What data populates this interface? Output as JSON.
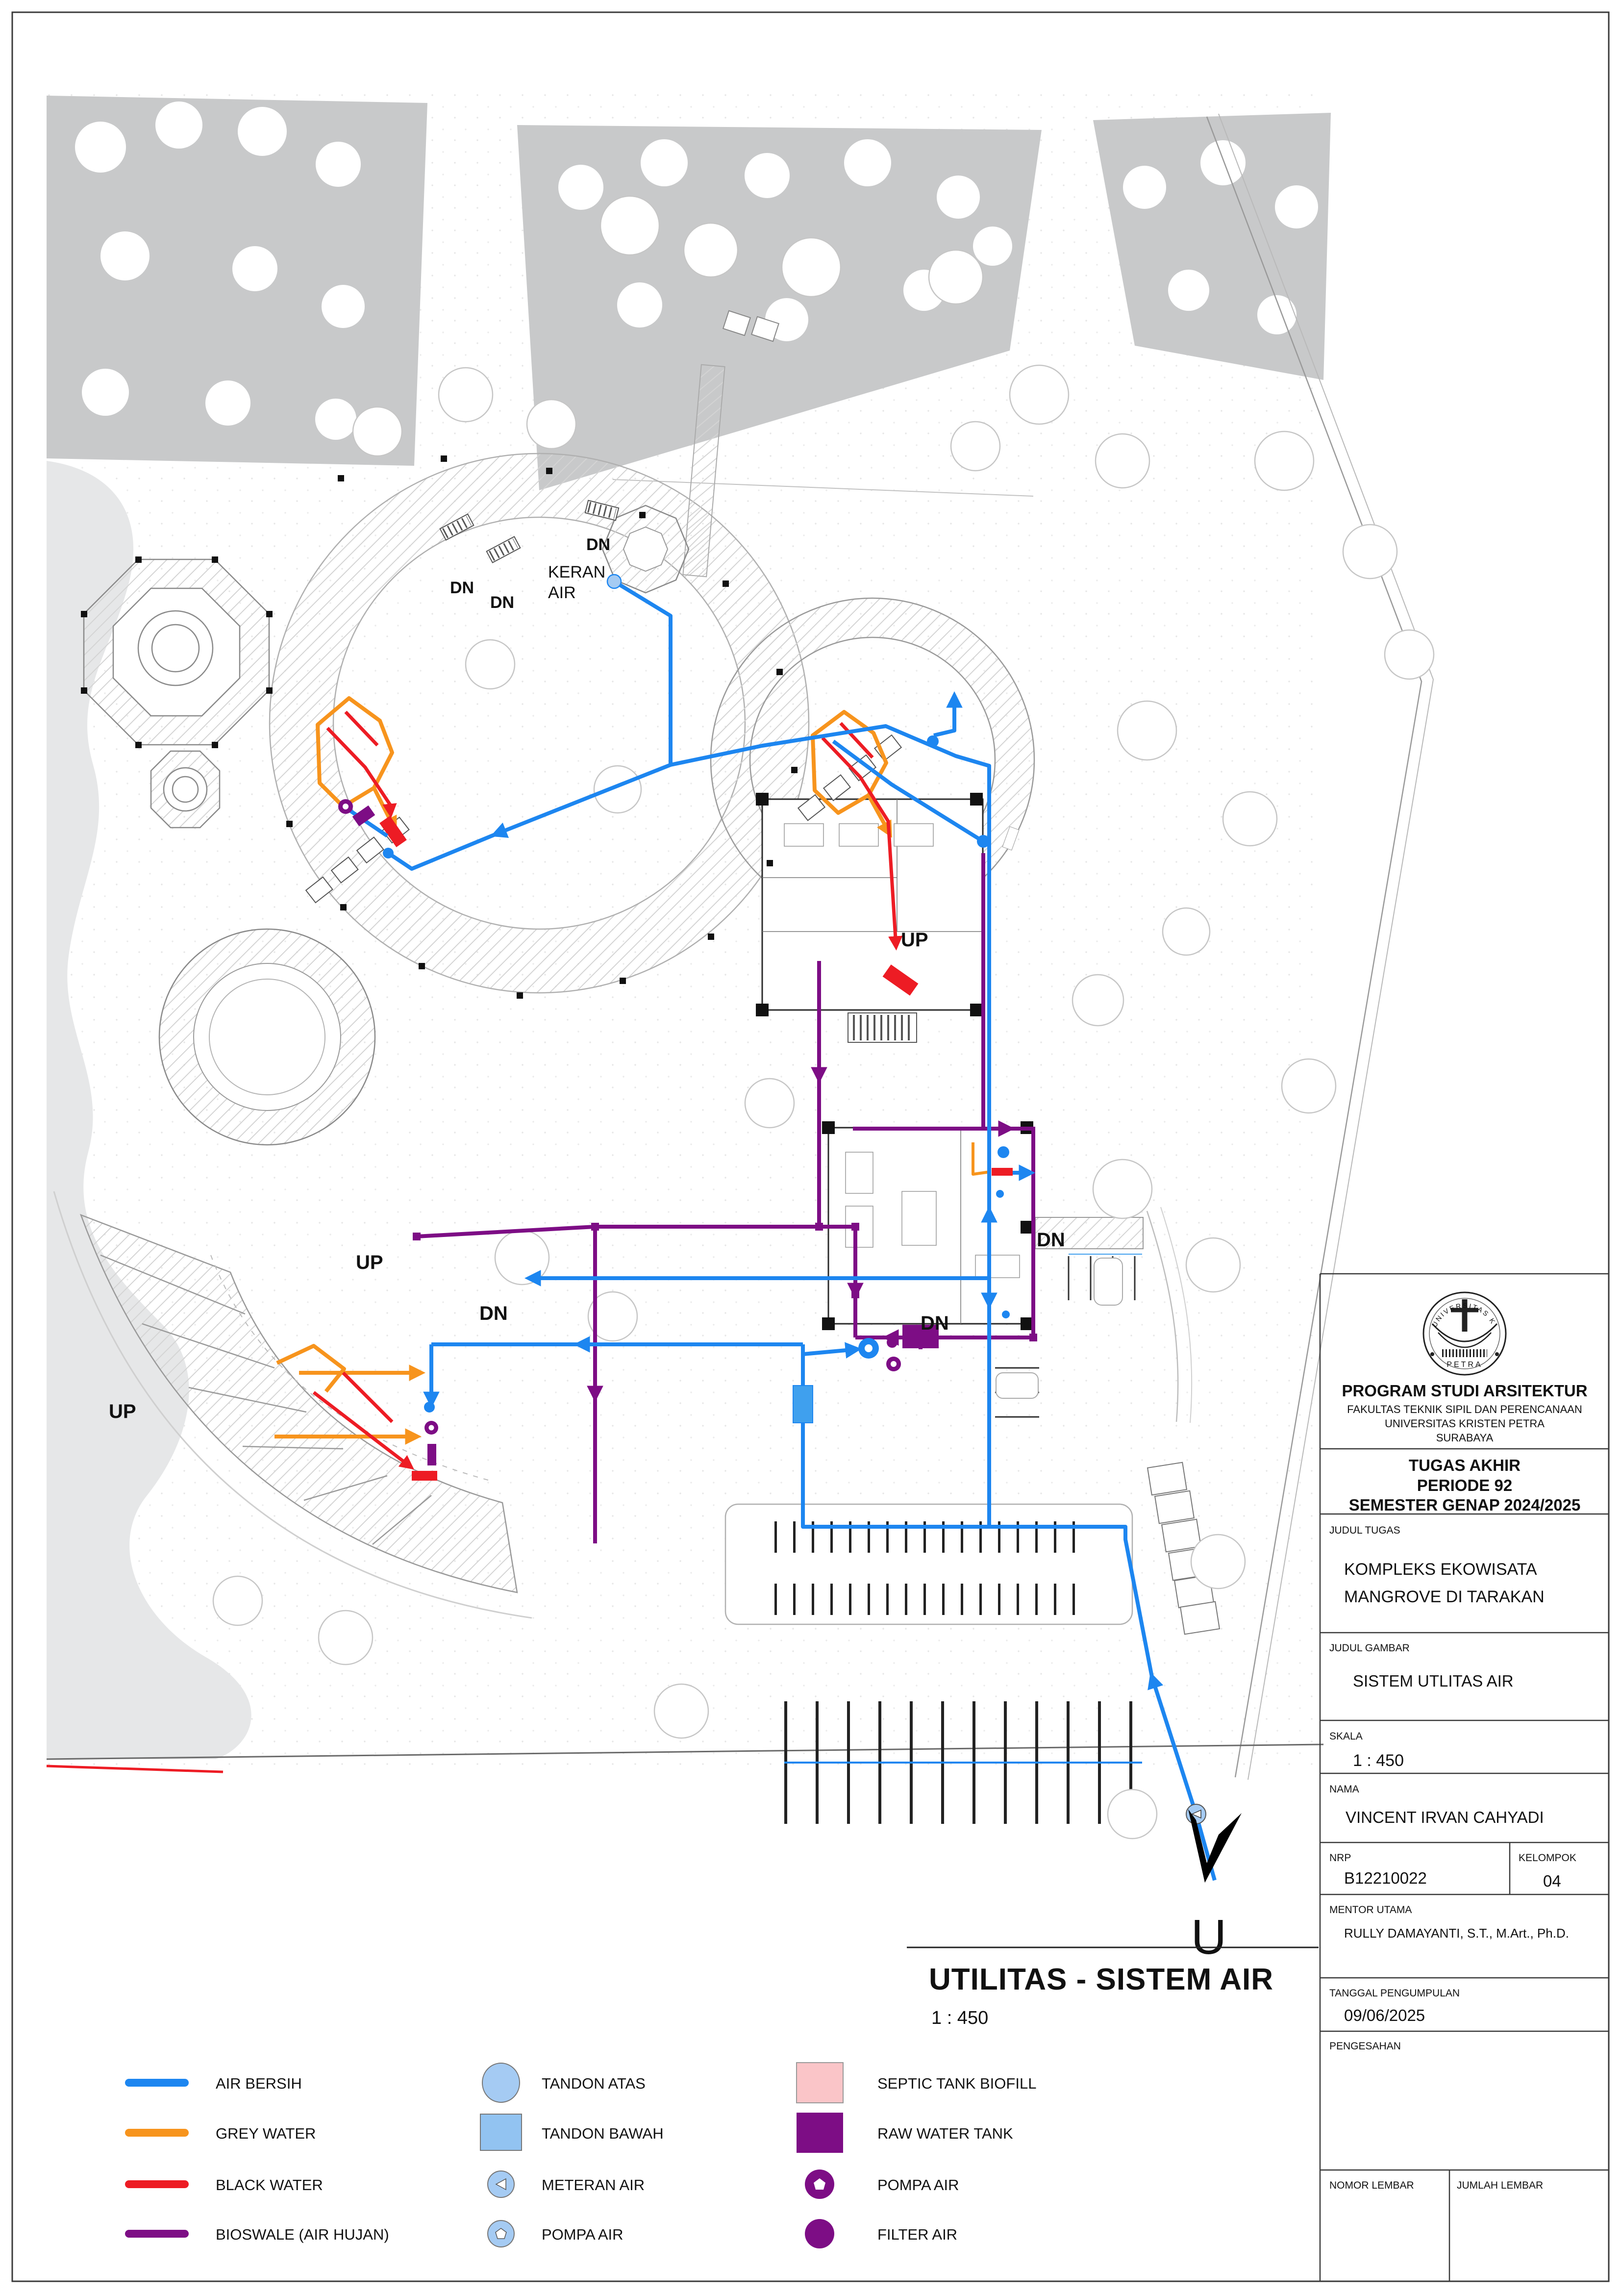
{
  "plan": {
    "labels": {
      "dn": "DN",
      "up": "UP",
      "keran_line1": "KERAN",
      "keran_line2": "AIR",
      "north": "U"
    }
  },
  "drawing_title": {
    "title": "UTILITAS - SISTEM AIR",
    "scale": "1 : 450"
  },
  "legend": {
    "lines": [
      {
        "label": "AIR BERSIH",
        "color": "#1d86f0"
      },
      {
        "label": "GREY WATER",
        "color": "#F7941D"
      },
      {
        "label": "BLACK WATER",
        "color": "#ED1C24"
      },
      {
        "label": "BIOSWALE (AIR HUJAN)",
        "color": "#7D0D85"
      }
    ],
    "tanks": [
      {
        "label": "TANDON ATAS",
        "icon": "circle-lightblue"
      },
      {
        "label": "TANDON BAWAH",
        "icon": "square-lightblue"
      },
      {
        "label": "METERAN AIR",
        "icon": "circle-lightblue-triangle"
      },
      {
        "label": "POMPA AIR",
        "icon": "circle-lightblue-pentagon"
      }
    ],
    "devices": [
      {
        "label": "SEPTIC TANK BIOFILL",
        "icon": "square-pink"
      },
      {
        "label": "RAW WATER TANK",
        "icon": "square-purple"
      },
      {
        "label": "POMPA AIR",
        "icon": "donut-purple"
      },
      {
        "label": "FILTER AIR",
        "icon": "circle-purple"
      }
    ],
    "colors": {
      "lightblue": "#A5CBF3",
      "pink": "#FAC5C8",
      "purple": "#7D0D85",
      "tandon_plan": "#3FA0EE"
    }
  },
  "titleblock": {
    "logo_text_top": "UNIVERSITAS KRISTEN",
    "logo_text_bottom": "PETRA",
    "program": "PROGRAM STUDI ARSITEKTUR",
    "fakultas": "FAKULTAS TEKNIK SIPIL DAN PERENCANAAN",
    "universitas": "UNIVERSITAS KRISTEN PETRA",
    "kota": "SURABAYA",
    "tugas": "TUGAS AKHIR",
    "periode": "PERIODE 92",
    "semester": "SEMESTER GENAP 2024/2025",
    "judul_tugas_label": "JUDUL TUGAS",
    "judul_tugas_line1": "KOMPLEKS EKOWISATA",
    "judul_tugas_line2": "MANGROVE DI TARAKAN",
    "judul_gambar_label": "JUDUL GAMBAR",
    "judul_gambar": "SISTEM UTLITAS AIR",
    "skala_label": "SKALA",
    "skala": "1 : 450",
    "nama_label": "NAMA",
    "nama": "VINCENT IRVAN CAHYADI",
    "nrp_label": "NRP",
    "nrp": "B12210022",
    "kelompok_label": "KELOMPOK",
    "kelompok": "04",
    "mentor_label": "MENTOR UTAMA",
    "mentor": "RULLY DAMAYANTI, S.T., M.Art., Ph.D.",
    "tanggal_label": "TANGGAL PENGUMPULAN",
    "tanggal": "09/06/2025",
    "pengesahan_label": "PENGESAHAN",
    "nomor_label": "NOMOR LEMBAR",
    "jumlah_label": "JUMLAH LEMBAR"
  }
}
